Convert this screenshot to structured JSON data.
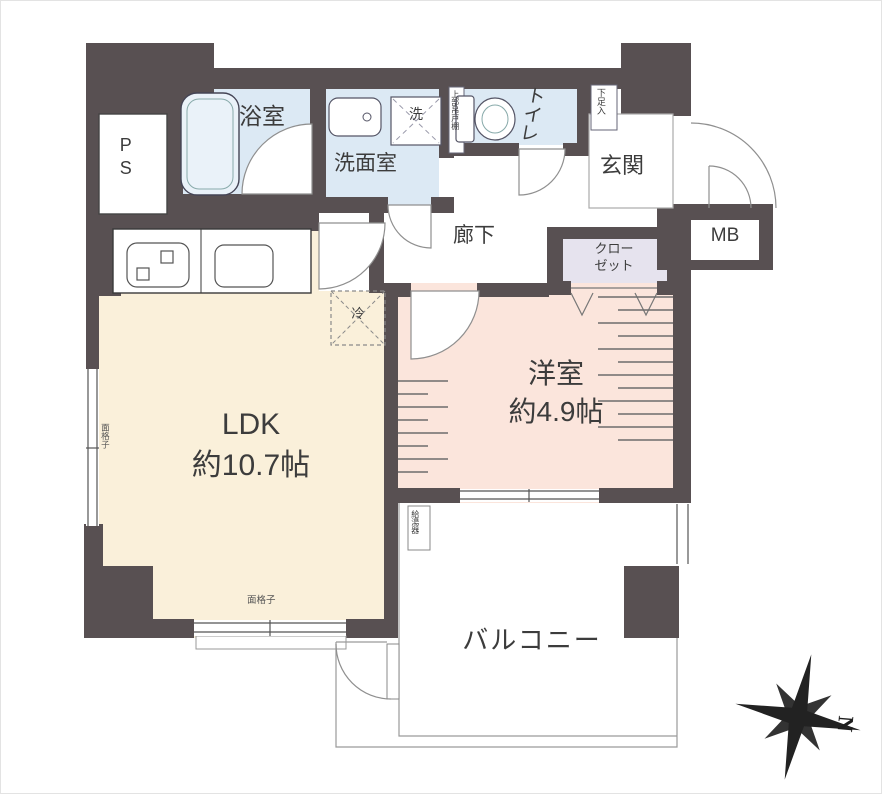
{
  "plan": {
    "rooms": {
      "ps": "PS",
      "bath": "浴室",
      "washroom": "洗面室",
      "washer_pan": "洗",
      "toilet": "トイレ",
      "toilet_upper_shelf": "上部吊戸棚",
      "shoe_cabinet": "下足入",
      "entrance": "玄関",
      "meter_box": "MB",
      "corridor": "廊下",
      "closet_line1": "クロー",
      "closet_line2": "ゼット",
      "ldk_name": "LDK",
      "ldk_size": "約10.7帖",
      "western_name": "洋室",
      "western_size": "約4.9帖",
      "balcony": "バルコニー",
      "refrigerator": "冷",
      "water_heater": "給湯器",
      "grille_left": "面格子",
      "grille_bottom": "面格子"
    },
    "compass": {
      "north": "N"
    },
    "colors": {
      "wall": "#585052",
      "wet_area": "#dce9f4",
      "ldk": "#faf0da",
      "western_room": "#fbe5dc",
      "closet": "#e6e3ee",
      "line": "#8f8f8f",
      "text": "#3c3c3c"
    }
  }
}
